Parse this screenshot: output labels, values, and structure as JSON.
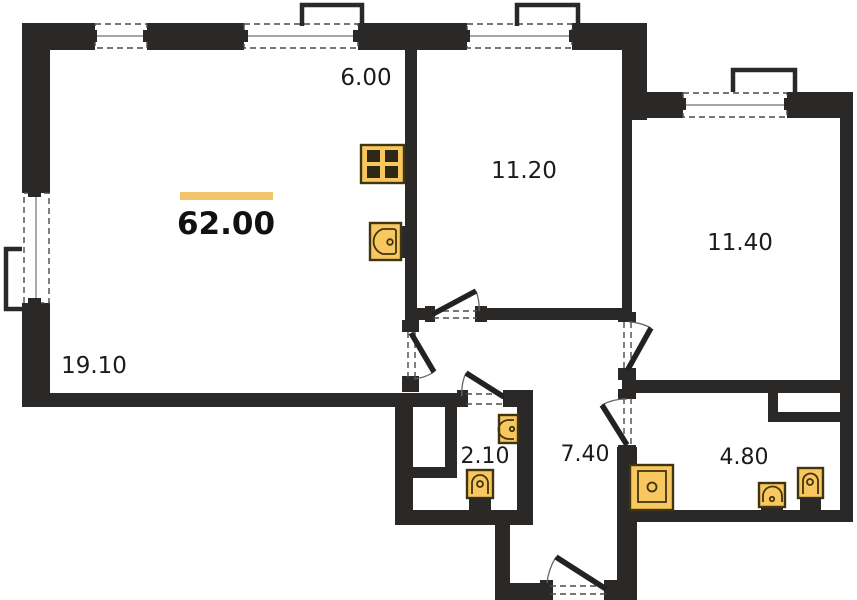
{
  "plan": {
    "title": "apartment-floor-plan",
    "total_area": "62.00"
  },
  "palette": {
    "wall": "#2a2927",
    "accent": "#f2c46b",
    "fix_fill": "#f8c75f",
    "fix_stroke": "#41350f",
    "text": "#1b1b1b"
  },
  "rooms": [
    {
      "key": "kitchen-zone",
      "area": "6.00"
    },
    {
      "key": "living-zone",
      "area": "19.10"
    },
    {
      "key": "bedroom-1",
      "area": "11.20"
    },
    {
      "key": "bedroom-2",
      "area": "11.40"
    },
    {
      "key": "bathroom-small",
      "area": "2.10"
    },
    {
      "key": "hallway",
      "area": "7.40"
    },
    {
      "key": "bathroom-large",
      "area": "4.80"
    }
  ],
  "fixtures": [
    {
      "name": "stove",
      "room": "kitchen-zone"
    },
    {
      "name": "kitchen-sink",
      "room": "kitchen-zone"
    },
    {
      "name": "toilet",
      "room": "bathroom-small"
    },
    {
      "name": "washbasin",
      "room": "bathroom-small"
    },
    {
      "name": "shower-tray",
      "room": "bathroom-large"
    },
    {
      "name": "washbasin",
      "room": "bathroom-large"
    },
    {
      "name": "toilet",
      "room": "bathroom-large"
    }
  ]
}
